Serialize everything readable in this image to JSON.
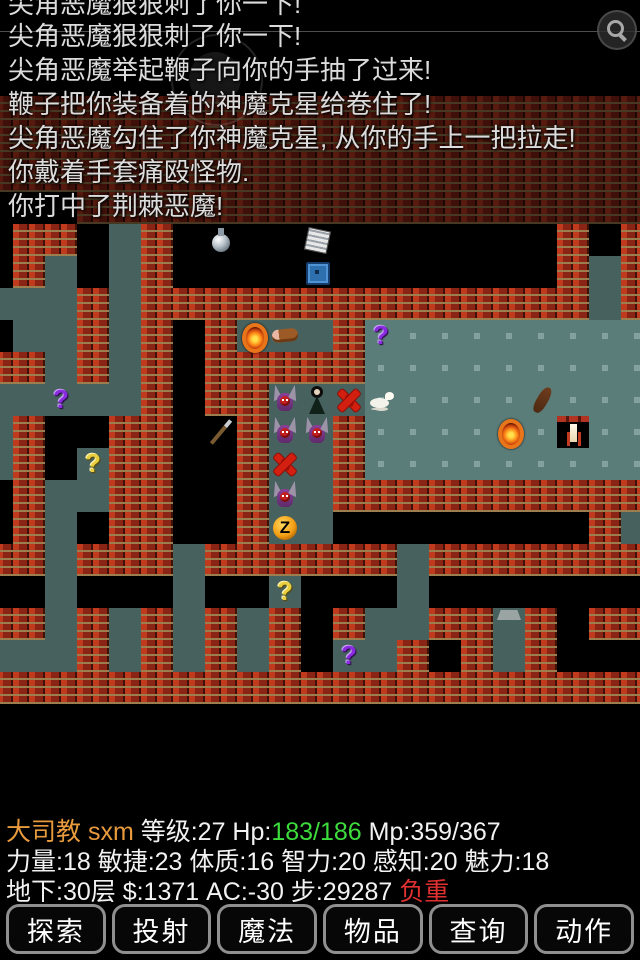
{
  "messages": {
    "lines": [
      {
        "text": "尖角恶魔狠狠刺了你一下!",
        "clipped": true
      },
      {
        "text": "尖角恶魔狠狠刺了你一下!",
        "clipped": false
      },
      {
        "text": "尖角恶魔举起鞭子向你的手抽了过来!",
        "clipped": false
      },
      {
        "text": "鞭子把你装备着的神魔克星给卷住了!",
        "clipped": false
      },
      {
        "text": "尖角恶魔勾住了你神魔克星, 从你的手上一把拉走!",
        "clipped": false
      },
      {
        "text": "你戴着手套痛殴怪物.",
        "clipped": false
      },
      {
        "text": "你打中了荆棘恶魔!",
        "clipped": false
      }
    ]
  },
  "map": {
    "tile_size": 32,
    "origin": {
      "x": -19,
      "y": 96
    },
    "legend": {
      "#": "brick-wall",
      ".": "corridor-floor",
      "R": "room-floor",
      " ": "unexplored"
    },
    "colors": {
      "wall_brick": "#a72c18",
      "wall_mortar": "#9b7d4e",
      "corridor": "#47615e",
      "room": "#5b7d7a",
      "room_dot": "#84a19d",
      "background": "#000000"
    },
    "grid": [
      "#####################",
      "#####################",
      "#####################",
      "   ##################",
      " ## .#            # #",
      " #. .#            #.#",
      "...#.##############.#",
      " ..#.# #...#RRRRRRRRR",
      "##.#.# #####RRRRRRRRR",
      ".....# ##...RRRRRRRRR",
      ".#  ##  #..#RRRRRRRRR",
      ".# .##  #..#RRRRRRRRR",
      " #..##  #..##########",
      " #. ##  #..        #.",
      "##.###.######.#######",
      "  .   .  .   .       ",
      "##.#.#.#.# #..##.# ##",
      "...#.#.#.# ..# #.#   ",
      "#####################",
      "                     ",
      "                     ",
      "                     "
    ],
    "ghost_rows": 4,
    "sprites": [
      {
        "kind": "potion",
        "name": "potion-item",
        "c": 7,
        "r": 0
      },
      {
        "kind": "scroll",
        "name": "scroll-item",
        "c": 10,
        "r": 0
      },
      {
        "kind": "chest",
        "name": "chest-item",
        "c": 10,
        "r": 1
      },
      {
        "kind": "amulet",
        "name": "amulet-item",
        "c": 8,
        "r": 3
      },
      {
        "kind": "meat",
        "name": "meat-item",
        "c": 9,
        "r": 3
      },
      {
        "kind": "qmark qpurple",
        "name": "unknown-scroll",
        "label": "?",
        "c": 12,
        "r": 3
      },
      {
        "kind": "qmark qpurple",
        "name": "unknown-scroll",
        "label": "?",
        "c": 2,
        "r": 5
      },
      {
        "kind": "pdemon",
        "name": "horned-demon",
        "c": 9,
        "r": 5
      },
      {
        "kind": "lady",
        "name": "dark-figure",
        "c": 10,
        "r": 5
      },
      {
        "kind": "rdemon",
        "name": "red-demon",
        "c": 11,
        "r": 5
      },
      {
        "kind": "dog",
        "name": "white-animal",
        "c": 12,
        "r": 5
      },
      {
        "kind": "club",
        "name": "club-item",
        "c": 17,
        "r": 5
      },
      {
        "kind": "polearm",
        "name": "polearm-item",
        "c": 7,
        "r": 6
      },
      {
        "kind": "pdemon",
        "name": "horned-demon",
        "c": 9,
        "r": 6
      },
      {
        "kind": "pdemon",
        "name": "horned-demon",
        "c": 10,
        "r": 6
      },
      {
        "kind": "amulet",
        "name": "amulet-item",
        "c": 16,
        "r": 6
      },
      {
        "kind": "niche",
        "name": "white-statue-niche",
        "c": 18,
        "r": 6
      },
      {
        "kind": "qmark qyellow",
        "name": "unknown-scroll",
        "label": "?",
        "c": 3,
        "r": 7
      },
      {
        "kind": "rdemon",
        "name": "red-demon",
        "c": 9,
        "r": 7
      },
      {
        "kind": "pdemon",
        "name": "horned-demon",
        "c": 9,
        "r": 8
      },
      {
        "kind": "zsym",
        "name": "z-symbol",
        "label": "Z",
        "c": 9,
        "r": 9
      },
      {
        "kind": "qmark qyellow",
        "name": "unknown-scroll",
        "label": "?",
        "c": 9,
        "r": 11
      },
      {
        "kind": "stairs",
        "name": "staircase",
        "c": 16,
        "r": 12
      },
      {
        "kind": "qmark qpurple",
        "name": "unknown-scroll",
        "label": "?",
        "c": 11,
        "r": 13
      }
    ]
  },
  "status": {
    "colors": {
      "name": "#e89a3c",
      "hp": "#3ddc3d",
      "warn": "#e03030",
      "default": "#f2f2f2"
    },
    "line1": [
      {
        "text": "大司教 sxm ",
        "color": "name"
      },
      {
        "text": "等级:27 Hp:",
        "color": "default"
      },
      {
        "text": "183/186",
        "color": "hp"
      },
      {
        "text": " Mp:359/367",
        "color": "default"
      }
    ],
    "line2": [
      {
        "text": "力量:18 敏捷:23 体质:16 智力:20 感知:20 魅力:18",
        "color": "default"
      }
    ],
    "line3": [
      {
        "text": "地下:30层 $:1371 AC:-30 步:29287 ",
        "color": "default"
      },
      {
        "text": "负重",
        "color": "warn"
      }
    ]
  },
  "toolbar": {
    "buttons": [
      {
        "label": "探索",
        "name": "explore-button"
      },
      {
        "label": "投射",
        "name": "throw-button"
      },
      {
        "label": "魔法",
        "name": "magic-button"
      },
      {
        "label": "物品",
        "name": "items-button"
      },
      {
        "label": "查询",
        "name": "query-button"
      },
      {
        "label": "动作",
        "name": "actions-button"
      }
    ]
  }
}
